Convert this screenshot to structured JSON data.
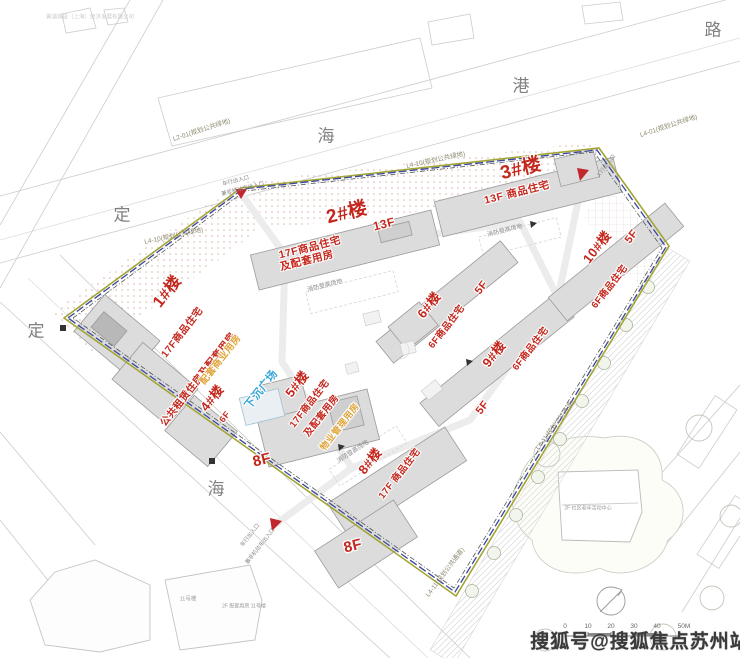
{
  "colors": {
    "label_red": "#c4271d",
    "label_yellow": "#dfa43a",
    "label_blue": "#38a5da",
    "boundary_blue": "#3847a0",
    "green_line": "#a3a433",
    "watermark_gray": "#3a3a3a"
  },
  "streets": [
    "路",
    "港",
    "海",
    "定",
    "定",
    "海"
  ],
  "parcel_labels": [
    "L2-01(规划公共绿地)",
    "L4-10(规划公共绿地)",
    "L4-10(规划公共绿地)",
    "L4-01(规划公共绿地)",
    "L4-11(规划公共通道)",
    "L4-11(规划公共通道)"
  ],
  "buildings": [
    {
      "name": "1#楼",
      "use1": "17F商品住宅",
      "use2": "公共租赁住房及配套用房",
      "podium": "配套商业用房"
    },
    {
      "name": "2#楼",
      "use1": "17F商品住宅",
      "use2": "及配套用房",
      "floor_tag": "13F"
    },
    {
      "name": "3#楼",
      "use1": "13F 商品住宅"
    },
    {
      "name": "4#楼",
      "floor_tag": "6F"
    },
    {
      "name": "5#楼",
      "use1": "17F商品住宅",
      "use2": "及配套用房",
      "podium": "物业管理用房"
    },
    {
      "name": "6#楼",
      "use1": "6F商品住宅",
      "floor_tag": "5F"
    },
    {
      "name": "8#楼",
      "use1": "17F 商品住宅"
    },
    {
      "name": "9#楼",
      "use1": "6F商品住宅",
      "floor_tag": "5F"
    },
    {
      "name": "10#楼",
      "use1": "6F商品住宅",
      "floor_tag": "5F"
    }
  ],
  "floor_labels": [
    "8F",
    "8F"
  ],
  "features": {
    "sunken_plaza": "下沉广场"
  },
  "notes": {
    "fire_lane": "消防登高场地",
    "vehicle_entrance": "车行出入口",
    "mixed_entrance": "兼非机动车出入口",
    "pedestrian_entrance": "人行出入口"
  },
  "adjacent": {
    "bldg11": "11号楼",
    "bldg11_note": "2F 配套用房 11号楼",
    "community_center": "2F 社区老年活动中心",
    "company_note": "黄浦城投（上海）经济发展有限公司"
  },
  "scale_bar": {
    "ticks": [
      "0",
      "10",
      "20",
      "30",
      "40",
      "50M"
    ]
  },
  "watermark": "搜狐号@搜狐焦点苏州站"
}
